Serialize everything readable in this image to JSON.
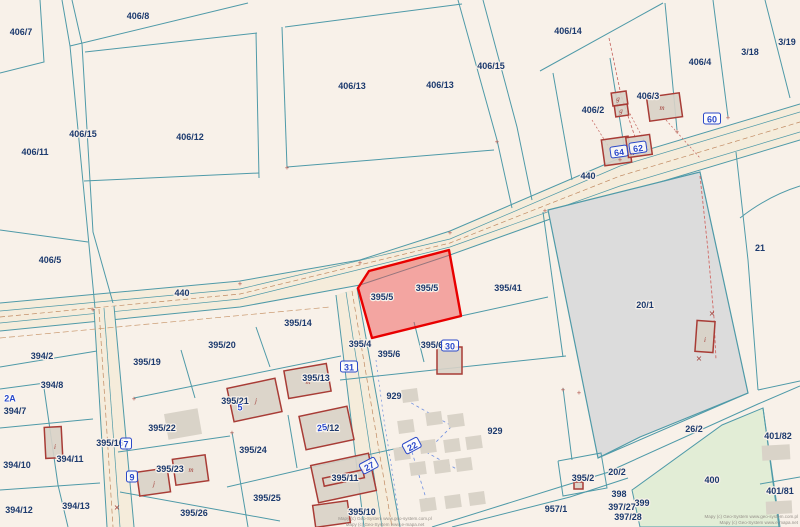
{
  "map": {
    "colors": {
      "background": "#f8f1e9",
      "boundary": "#4f9aa8",
      "label": "#1c3a6e",
      "marker_blue": "#2b49c9",
      "road_fill": "#f5ecdb",
      "building_fill": "rgba(216,210,199,0.9)",
      "building_stroke": "#a83c36",
      "shed_fill": "#d9d3c8",
      "selected_fill": "rgba(237,74,74,0.45)",
      "selected_stroke": "#e80000",
      "gray_parcel_fill": "#dcdcdc",
      "green_parcel_fill": "#e2edd6"
    },
    "roads": [
      {
        "name": "road-440",
        "surface": "0,303 240,281 360,260 450,231 620,158 800,104 800,140 620,194 450,255 360,285 240,307 0,331",
        "edges": [
          "0,303 240,281 360,260 450,231 620,158 800,104",
          "0,331 240,307 360,285 450,255 620,194 800,140"
        ],
        "teal": [
          "0,311 240,289 450,239 620,166 800,112",
          "0,323 240,299 450,247 620,186 800,132"
        ],
        "brown": [
          "0,317 240,294 450,243 620,176 800,122"
        ]
      },
      {
        "name": "road-center",
        "surface": "336,295 357,288 400,527 364,527",
        "edges": [
          "336,295 364,527",
          "357,288 400,527"
        ],
        "teal": [
          "346,292 382,527"
        ],
        "brown": [
          "352,291 392,527"
        ]
      },
      {
        "name": "road-left",
        "surface": "94,309 114,306 134,527 107,527",
        "edges": [
          "94,309 107,527",
          "114,306 134,527"
        ],
        "teal": [
          "104,308 120,527"
        ],
        "brown": [
          "99,309 113,527"
        ]
      }
    ],
    "special_parcels": [
      {
        "name": "parcel-20-1",
        "label": "20/1",
        "points": "548,210 700,172 748,393 640,437 598,458",
        "fill": "#dcdcdc",
        "stroke": "#4f9aa8",
        "width": 1.2,
        "interactable": false
      },
      {
        "name": "parcel-400",
        "label": "400",
        "points": "632,490 722,425 763,408 779,527 640,527",
        "fill": "#e2edd6",
        "stroke": "#4f9aa8",
        "width": 1,
        "interactable": false
      }
    ],
    "selected_parcel": {
      "label": "395/5",
      "points": "449,250 461,316 372,338 358,288 369,271",
      "fill": "rgba(237,74,74,0.45)",
      "stroke": "#e80000",
      "width": 2.4
    },
    "boundaries": [
      "40,0 44,62 0,73",
      "62,0 70,46 95,308",
      "72,0 82,44",
      "82,44 93,232 113,303",
      "70,46 248,3",
      "85,52 257,33",
      "285,27 462,4",
      "256,33 259,178",
      "282,27 287,167",
      "84,181 259,173",
      "287,167 494,150",
      "458,0 497,140 512,208",
      "483,0 517,127 532,200",
      "0,230 88,242",
      "540,71 663,3",
      "665,3 677,130",
      "713,0 728,117",
      "765,0 790,98",
      "553,73 572,180",
      "610,58 625,152",
      "736,152 748,260 758,390",
      "758,390 800,381",
      "598,458 748,393",
      "612,470 758,404 800,386",
      "763,408 780,527",
      "760,484 800,477",
      "0,367 97,351",
      "0,389 60,381",
      "0,428 93,419",
      "0,490 100,483",
      "44,388 58,485 68,527",
      "134,398 341,356",
      "181,350 195,398",
      "256,327 270,367",
      "118,452 230,436",
      "232,432 248,527",
      "120,492 280,521",
      "227,487 313,467 403,447",
      "288,415 297,468",
      "340,380 566,356",
      "414,322 424,362",
      "461,316 548,297",
      "543,212 563,357",
      "563,388 572,460",
      "432,527 560,487 622,468",
      "452,527 570,497 628,478",
      "558,461 601,453 607,488 563,496 558,461"
    ],
    "curves": [
      "M 740,218 Q 768,196 800,186"
    ],
    "survey_lines": [
      {
        "points": "609,38 621,95 636,140",
        "color": "#c4625c",
        "w": 0.8,
        "dash": "3 2"
      },
      {
        "points": "700,176 708,250 714,318 716,360",
        "color": "#d06a66",
        "w": 0.9,
        "dash": "3 2"
      },
      {
        "points": "628,110 648,148",
        "color": "#c4625c",
        "w": 0.7,
        "dash": "2 2"
      },
      {
        "points": "592,120 612,152",
        "color": "#c4625c",
        "w": 0.7,
        "dash": "2 2"
      },
      {
        "points": "666,120 700,158",
        "color": "#c4625c",
        "w": 0.7,
        "dash": "2 2"
      },
      {
        "points": "0,338 330,307",
        "color": "#c9996f",
        "w": 0.7,
        "dash": "6 3"
      },
      {
        "points": "406,400 452,426 426,452 462,472",
        "color": "#6f8fe0",
        "w": 0.8,
        "dash": "3 3"
      },
      {
        "points": "412,452 428,505",
        "color": "#6f8fe0",
        "w": 0.8,
        "dash": "3 3"
      },
      {
        "points": "376,360 384,420 392,470 398,510",
        "color": "#6f8fe0",
        "w": 0.7,
        "dash": "2 3"
      }
    ],
    "gray_buildings": [
      {
        "x": 166,
        "y": 411,
        "w": 34,
        "h": 26,
        "rot": -10
      },
      {
        "x": 402,
        "y": 389,
        "w": 16,
        "h": 13,
        "rot": -8
      },
      {
        "x": 426,
        "y": 412,
        "w": 16,
        "h": 13,
        "rot": -8
      },
      {
        "x": 398,
        "y": 420,
        "w": 16,
        "h": 13,
        "rot": -8
      },
      {
        "x": 448,
        "y": 414,
        "w": 16,
        "h": 13,
        "rot": -8
      },
      {
        "x": 420,
        "y": 440,
        "w": 16,
        "h": 13,
        "rot": -8
      },
      {
        "x": 394,
        "y": 447,
        "w": 16,
        "h": 13,
        "rot": -8
      },
      {
        "x": 444,
        "y": 439,
        "w": 16,
        "h": 13,
        "rot": -8
      },
      {
        "x": 466,
        "y": 436,
        "w": 16,
        "h": 13,
        "rot": -8
      },
      {
        "x": 410,
        "y": 462,
        "w": 16,
        "h": 13,
        "rot": -8
      },
      {
        "x": 434,
        "y": 460,
        "w": 16,
        "h": 13,
        "rot": -8
      },
      {
        "x": 456,
        "y": 458,
        "w": 16,
        "h": 13,
        "rot": -8
      },
      {
        "x": 420,
        "y": 498,
        "w": 16,
        "h": 13,
        "rot": -8
      },
      {
        "x": 445,
        "y": 495,
        "w": 16,
        "h": 13,
        "rot": -8
      },
      {
        "x": 469,
        "y": 492,
        "w": 16,
        "h": 13,
        "rot": -8
      },
      {
        "x": 762,
        "y": 445,
        "w": 28,
        "h": 15,
        "rot": -3
      },
      {
        "x": 766,
        "y": 501,
        "w": 26,
        "h": 13,
        "rot": -3
      }
    ],
    "buildings": [
      {
        "x": 612,
        "y": 92,
        "w": 15,
        "h": 13,
        "rot": -8
      },
      {
        "x": 615,
        "y": 105,
        "w": 13,
        "h": 11,
        "rot": -8
      },
      {
        "x": 648,
        "y": 95,
        "w": 33,
        "h": 24,
        "rot": -8
      },
      {
        "x": 603,
        "y": 138,
        "w": 27,
        "h": 26,
        "rot": -8
      },
      {
        "x": 627,
        "y": 136,
        "w": 24,
        "h": 20,
        "rot": -8
      },
      {
        "x": 696,
        "y": 321,
        "w": 18,
        "h": 31,
        "rot": 4
      },
      {
        "x": 437,
        "y": 347,
        "w": 25,
        "h": 27,
        "rot": 0
      },
      {
        "x": 286,
        "y": 367,
        "w": 43,
        "h": 28,
        "rot": -10
      },
      {
        "x": 230,
        "y": 383,
        "w": 49,
        "h": 34,
        "rot": -12
      },
      {
        "x": 302,
        "y": 411,
        "w": 49,
        "h": 34,
        "rot": -12
      },
      {
        "x": 314,
        "y": 459,
        "w": 59,
        "h": 38,
        "rot": -12,
        "inner": true
      },
      {
        "x": 138,
        "y": 470,
        "w": 31,
        "h": 24,
        "rot": -8
      },
      {
        "x": 174,
        "y": 457,
        "w": 33,
        "h": 26,
        "rot": -8
      },
      {
        "x": 45,
        "y": 427,
        "w": 17,
        "h": 31,
        "rot": -3
      },
      {
        "x": 314,
        "y": 503,
        "w": 35,
        "h": 22,
        "rot": -8
      },
      {
        "x": 574,
        "y": 482,
        "w": 9,
        "h": 7,
        "rot": 0
      }
    ],
    "building_letters": [
      {
        "t": "g",
        "x": 618,
        "y": 101
      },
      {
        "t": "g",
        "x": 621,
        "y": 113
      },
      {
        "t": "m",
        "x": 662,
        "y": 110
      },
      {
        "t": "m",
        "x": 632,
        "y": 155
      },
      {
        "t": "m",
        "x": 308,
        "y": 384
      },
      {
        "t": "j",
        "x": 256,
        "y": 403
      },
      {
        "t": "m",
        "x": 327,
        "y": 432
      },
      {
        "t": "i",
        "x": 55,
        "y": 449
      },
      {
        "t": "j",
        "x": 154,
        "y": 486
      },
      {
        "t": "m",
        "x": 191,
        "y": 472
      },
      {
        "t": "i",
        "x": 705,
        "y": 342
      }
    ],
    "ticks": [
      [
        93,
        310
      ],
      [
        240,
        284
      ],
      [
        360,
        263
      ],
      [
        450,
        233
      ],
      [
        545,
        211
      ],
      [
        620,
        160
      ],
      [
        728,
        118
      ],
      [
        677,
        132
      ],
      [
        287,
        168
      ],
      [
        497,
        142
      ],
      [
        563,
        390
      ],
      [
        134,
        399
      ],
      [
        579,
        393
      ],
      [
        232,
        433
      ]
    ],
    "crosses": [
      [
        117,
        507
      ],
      [
        712,
        313
      ],
      [
        699,
        358
      ]
    ],
    "parcel_labels": [
      {
        "t": "406/7",
        "x": 21,
        "y": 32
      },
      {
        "t": "406/8",
        "x": 138,
        "y": 16
      },
      {
        "t": "406/13",
        "x": 352,
        "y": 86
      },
      {
        "t": "406/13",
        "x": 440,
        "y": 85
      },
      {
        "t": "406/15",
        "x": 491,
        "y": 66
      },
      {
        "t": "406/14",
        "x": 568,
        "y": 31
      },
      {
        "t": "406/4",
        "x": 700,
        "y": 62
      },
      {
        "t": "3/18",
        "x": 750,
        "y": 52
      },
      {
        "t": "3/19",
        "x": 787,
        "y": 42
      },
      {
        "t": "406/3",
        "x": 648,
        "y": 96
      },
      {
        "t": "406/2",
        "x": 593,
        "y": 110
      },
      {
        "t": "406/15",
        "x": 83,
        "y": 134
      },
      {
        "t": "406/12",
        "x": 190,
        "y": 137
      },
      {
        "t": "406/11",
        "x": 35,
        "y": 152
      },
      {
        "t": "440",
        "x": 588,
        "y": 176
      },
      {
        "t": "21",
        "x": 760,
        "y": 248
      },
      {
        "t": "406/5",
        "x": 50,
        "y": 260
      },
      {
        "t": "440",
        "x": 182,
        "y": 293
      },
      {
        "t": "20/1",
        "x": 645,
        "y": 305
      },
      {
        "t": "395/5",
        "x": 382,
        "y": 297
      },
      {
        "t": "395/5",
        "x": 427,
        "y": 288
      },
      {
        "t": "395/41",
        "x": 508,
        "y": 288
      },
      {
        "t": "395/14",
        "x": 298,
        "y": 323
      },
      {
        "t": "395/4",
        "x": 360,
        "y": 344
      },
      {
        "t": "395/6",
        "x": 432,
        "y": 345
      },
      {
        "t": "395/6",
        "x": 389,
        "y": 354
      },
      {
        "t": "395/20",
        "x": 222,
        "y": 345
      },
      {
        "t": "395/19",
        "x": 147,
        "y": 362
      },
      {
        "t": "394/2",
        "x": 42,
        "y": 356
      },
      {
        "t": "395/13",
        "x": 316,
        "y": 378
      },
      {
        "t": "394/8",
        "x": 52,
        "y": 385
      },
      {
        "t": "929",
        "x": 394,
        "y": 396
      },
      {
        "t": "395/21",
        "x": 235,
        "y": 401
      },
      {
        "t": "394/7",
        "x": 15,
        "y": 411
      },
      {
        "t": "395/22",
        "x": 162,
        "y": 428
      },
      {
        "t": "24/12",
        "x": 328,
        "y": 428
      },
      {
        "t": "929",
        "x": 495,
        "y": 431
      },
      {
        "t": "26/2",
        "x": 694,
        "y": 429
      },
      {
        "t": "401/82",
        "x": 778,
        "y": 436
      },
      {
        "t": "395/16",
        "x": 110,
        "y": 443
      },
      {
        "t": "395/24",
        "x": 253,
        "y": 450
      },
      {
        "t": "394/10",
        "x": 17,
        "y": 465
      },
      {
        "t": "394/11",
        "x": 70,
        "y": 459
      },
      {
        "t": "20/2",
        "x": 617,
        "y": 472
      },
      {
        "t": "395/23",
        "x": 170,
        "y": 469
      },
      {
        "t": "395/11",
        "x": 345,
        "y": 478
      },
      {
        "t": "395/2",
        "x": 583,
        "y": 478
      },
      {
        "t": "400",
        "x": 712,
        "y": 480
      },
      {
        "t": "401/81",
        "x": 780,
        "y": 491
      },
      {
        "t": "398",
        "x": 619,
        "y": 494
      },
      {
        "t": "395/25",
        "x": 267,
        "y": 498
      },
      {
        "t": "399",
        "x": 642,
        "y": 503
      },
      {
        "t": "394/13",
        "x": 76,
        "y": 506
      },
      {
        "t": "397/27",
        "x": 622,
        "y": 507
      },
      {
        "t": "957/1",
        "x": 556,
        "y": 509
      },
      {
        "t": "394/12",
        "x": 19,
        "y": 510
      },
      {
        "t": "395/10",
        "x": 362,
        "y": 512
      },
      {
        "t": "395/26",
        "x": 194,
        "y": 513
      },
      {
        "t": "397/28",
        "x": 628,
        "y": 517
      }
    ],
    "address_markers": [
      {
        "t": "60",
        "x": 712,
        "y": 119,
        "boxed": true
      },
      {
        "t": "64",
        "x": 619,
        "y": 152,
        "boxed": true,
        "rot": -8
      },
      {
        "t": "62",
        "x": 638,
        "y": 148,
        "boxed": true,
        "rot": -8
      },
      {
        "t": "2A",
        "x": 10,
        "y": 398
      },
      {
        "t": "7",
        "x": 126,
        "y": 444,
        "boxed": true
      },
      {
        "t": "9",
        "x": 132,
        "y": 477,
        "boxed": true
      },
      {
        "t": "31",
        "x": 349,
        "y": 367,
        "boxed": true
      },
      {
        "t": "30",
        "x": 450,
        "y": 346,
        "boxed": true
      },
      {
        "t": "22",
        "x": 412,
        "y": 446,
        "boxed": true,
        "rot": -28
      },
      {
        "t": "27",
        "x": 369,
        "y": 466,
        "boxed": true,
        "rot": -28
      },
      {
        "t": "25",
        "x": 322,
        "y": 427,
        "rot": -10
      },
      {
        "t": "5",
        "x": 240,
        "y": 407
      }
    ],
    "attribution": {
      "center": [
        "Mapy (c) Geo-System www.geo-system.com.pl",
        "Mapy (c) Geo-System www.e-mapa.net"
      ],
      "right": [
        "Mapy (c) Geo-System www.geo-system.com.pl",
        "Mapy (c) Geo-System www.e-mapa.net"
      ]
    }
  }
}
